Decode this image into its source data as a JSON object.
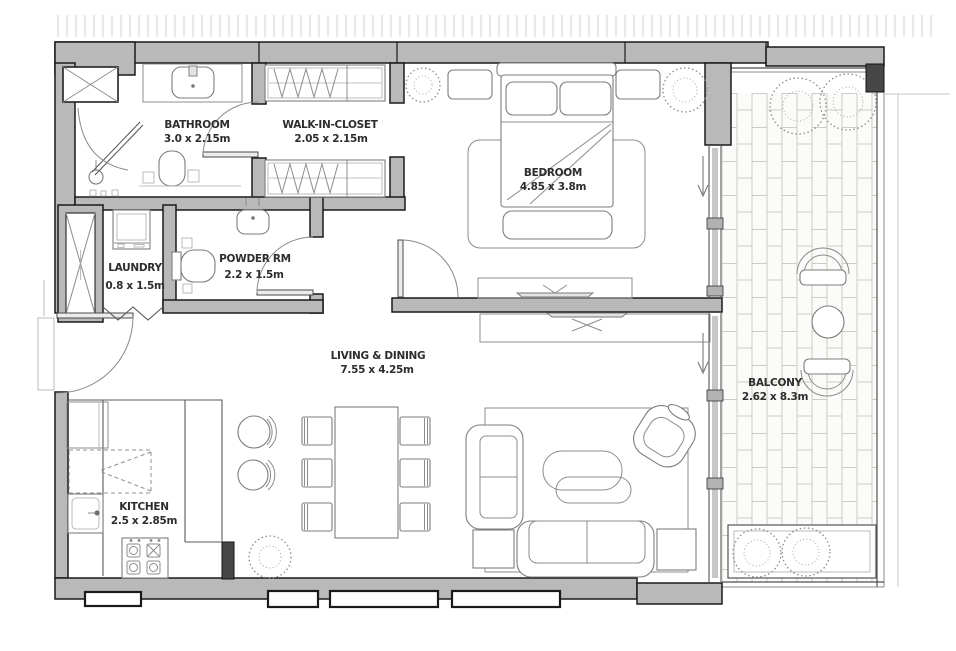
{
  "plan": {
    "type": "apartment-floor-plan",
    "rooms": [
      {
        "name": "BATHROOM",
        "dims": "3.0 x 2.15m"
      },
      {
        "name": "WALK-IN-CLOSET",
        "dims": "2.05 x 2.15m"
      },
      {
        "name": "BEDROOM",
        "dims": "4.85 x 3.8m"
      },
      {
        "name": "LAUNDRY",
        "dims": "0.8 x 1.5m"
      },
      {
        "name": "POWDER RM",
        "dims": "2.2 x 1.5m"
      },
      {
        "name": "LIVING & DINING",
        "dims": "7.55 x 4.25m"
      },
      {
        "name": "KITCHEN",
        "dims": "2.5 x 2.85m"
      },
      {
        "name": "BALCONY",
        "dims": "2.62 x 8.3m"
      }
    ],
    "colors": {
      "wall_fill": "#b9b9b9",
      "wall_outline": "#1a1a1a",
      "furniture_line": "#8c8c8c",
      "tile_line": "#ccccc4",
      "label_text": "#2d2d2d",
      "background": "#ffffff"
    }
  }
}
